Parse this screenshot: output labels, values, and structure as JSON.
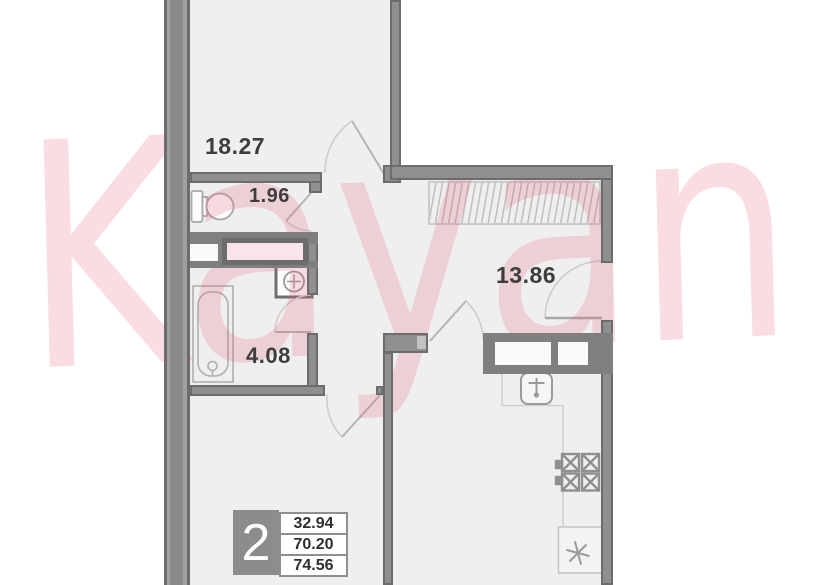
{
  "watermark": {
    "text": "Kayan"
  },
  "plan": {
    "rooms": [
      {
        "name": "bedroom",
        "area": "18.27"
      },
      {
        "name": "wc",
        "area": "1.96"
      },
      {
        "name": "bathroom",
        "area": "4.08"
      },
      {
        "name": "hallway",
        "area": "13.86"
      }
    ],
    "legend": {
      "rooms_count": "2",
      "living_area": "32.94",
      "floor_area": "70.20",
      "total_area": "74.56"
    }
  },
  "colors": {
    "wall": "#8f8f8f",
    "wall_edge": "#6c6c6c",
    "floor": "#f0efef",
    "watermark_pink": "#f7dbe1",
    "shaft_pink": "#f8e4ea",
    "label_text": "#3d3d3d",
    "badge_gray": "#8c8c8c"
  }
}
